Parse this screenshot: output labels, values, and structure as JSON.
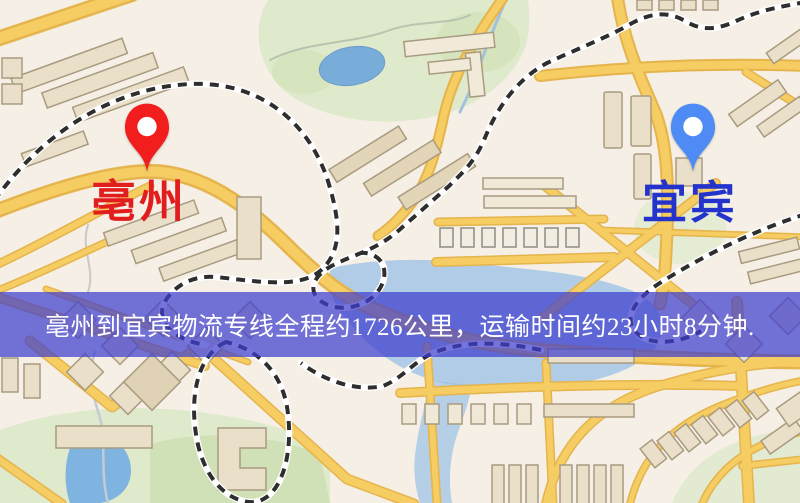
{
  "banner": {
    "text": "亳州到宜宾物流专线全程约1726公里，运输时间约23小时8分钟.",
    "text_color": "#ffffff",
    "overlay_color": "#3e3ece"
  },
  "route": {
    "origin": "亳州",
    "destination": "宜宾",
    "distance": "1726公里",
    "duration": "23小时8分钟"
  },
  "markers": {
    "origin": {
      "label": "亳州",
      "pin_color": "#f21d1d",
      "label_color": "#e21d1d"
    },
    "destination": {
      "label": "宜宾",
      "pin_color": "#4e8bf5",
      "label_color": "#2433cc"
    }
  },
  "icons": {
    "origin_pin": "location-pin",
    "destination_pin": "location-pin"
  },
  "map_palette": {
    "background": "#f5efe6",
    "road_fill": "#f6cd62",
    "road_casing": "#e5b44c",
    "building": "#eadfc8",
    "park": "#dfe9cc",
    "water": "#7fb3e0",
    "railway": "#2e2e2e"
  }
}
